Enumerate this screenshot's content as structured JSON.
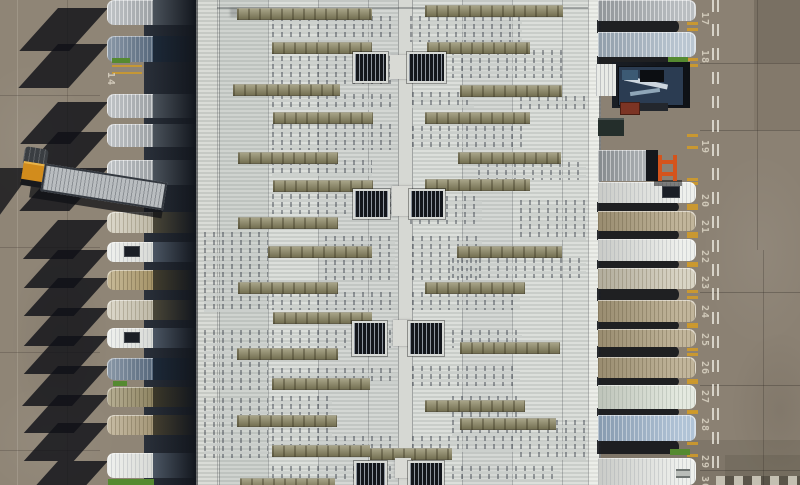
{
  "meta": {
    "title": "Aerial top-down view of a logistics warehouse: trailers docked at numbered loading bays on both sides of a corrugated roof with skylight strips and louvered vents",
    "width": 800,
    "height": 485
  },
  "palette": {
    "pavement_left": "#8f8576",
    "pavement_right": "#8b8173",
    "roof_light": "#dcdfdb",
    "roof_dark": "#c9cdc9",
    "fascia": "#d0d3ce",
    "ridge": "#d6d8d3",
    "skylight": "#8e8965",
    "vent_dark": "#13161b",
    "shadow": "#15161c",
    "dock_dark": "#12161d",
    "yellow_mark": "#cf9a2a",
    "grass_green": "#558a30",
    "tractor_orange": "#d28c1c",
    "forklift_orange": "#d4541c",
    "crate_red": "#7c3424",
    "flatbed_navy": "#2b3c52",
    "paint_white": "#ddd6c6",
    "trailer_types": {
      "silver": {
        "nose": "#a9aeb2",
        "mid": "#4e565f",
        "ribs": "rgba(255,255,255,0.5)"
      },
      "white": {
        "nose": "#eaece8",
        "mid": "#4f5a68",
        "ribs": "rgba(160,165,170,0.35)"
      },
      "navy": {
        "nose": "#5e7186",
        "mid": "#1d2a3a",
        "ribs": "rgba(255,255,255,0.25)"
      },
      "cream": {
        "nose": "#cfc9b6",
        "mid": "#4d4939",
        "ribs": "rgba(110,100,75,0.3)"
      },
      "gold": {
        "nose": "#b3a071",
        "mid": "#45402f",
        "ribs": "rgba(90,78,50,0.35)"
      },
      "olive": {
        "nose": "#9b906b",
        "mid": "#3e3a2a",
        "ribs": "rgba(80,72,48,0.35)"
      },
      "tan": {
        "nose": "#b2a382",
        "mid": "#474130",
        "ribs": "rgba(95,84,58,0.32)"
      },
      "mint": {
        "nose": "#dde4d8",
        "mid": "#4f5a50",
        "ribs": "rgba(150,160,150,0.35)"
      },
      "lightblue": {
        "nose": "#9db4cc",
        "mid": "#3c4a5c",
        "ribs": "rgba(255,255,255,0.4)"
      },
      "bluesilver": {
        "nose": "#a9b8c6",
        "mid": "#45505c",
        "ribs": "rgba(255,255,255,0.45)"
      },
      "grayshort": {
        "nose": "#9aa0a4",
        "mid": "#45494d",
        "ribs": "rgba(255,255,255,0.45)"
      }
    }
  },
  "left_yard": {
    "x": 0,
    "w": 196,
    "seams_v": [
      {
        "x": 17,
        "c": "rgba(232,227,216,0.18)"
      },
      {
        "x": 67,
        "c": "rgba(40,36,30,0.18)"
      }
    ],
    "seams_h": [
      95,
      247,
      352,
      450
    ],
    "yellow_dashes": [
      {
        "x": 112,
        "y": 65,
        "w": 30
      },
      {
        "x": 112,
        "y": 72,
        "w": 30
      }
    ],
    "bay_number": {
      "label": "14",
      "x": 103,
      "y": 72
    },
    "blotches": [
      {
        "x": -30,
        "y": 60,
        "w": 120,
        "h": 160,
        "c": "rgba(255,255,255,0.05)"
      },
      {
        "x": 10,
        "y": 250,
        "w": 100,
        "h": 180,
        "c": "rgba(40,35,28,0.08)"
      },
      {
        "x": -20,
        "y": 380,
        "w": 140,
        "h": 120,
        "c": "rgba(255,255,255,0.04)"
      }
    ],
    "green_slivers": [
      {
        "x": 112,
        "y": 58,
        "w": 18,
        "h": 5
      },
      {
        "x": 113,
        "y": 381,
        "w": 14,
        "h": 5
      },
      {
        "x": 108,
        "y": 479,
        "w": 46,
        "h": 6
      }
    ]
  },
  "right_yard": {
    "x": 598,
    "w": 202,
    "lane_lines_x": [
      712,
      717
    ],
    "seams_h": [
      63,
      130,
      292,
      385,
      470
    ],
    "seams_v": [
      {
        "x": 757,
        "y": 0,
        "h": 250
      },
      {
        "x": 763,
        "y": 250,
        "h": 235
      }
    ],
    "slabs": [
      {
        "x": 754,
        "y": 0,
        "w": 46,
        "h": 63,
        "c": "rgba(30,26,20,0.16)"
      },
      {
        "x": 754,
        "y": 63,
        "w": 46,
        "h": 67,
        "c": "rgba(30,26,20,0.07)"
      },
      {
        "x": 598,
        "y": 440,
        "w": 202,
        "h": 45,
        "c": "rgba(30,26,20,0.10)"
      },
      {
        "x": 725,
        "y": 455,
        "w": 75,
        "h": 30,
        "c": "rgba(30,26,20,0.10)"
      }
    ],
    "blotches": [
      {
        "x": 700,
        "y": 150,
        "w": 120,
        "h": 200,
        "c": "rgba(255,255,255,0.05)"
      },
      {
        "x": 730,
        "y": 330,
        "w": 100,
        "h": 160,
        "c": "rgba(35,30,22,0.09)"
      }
    ],
    "crosswalk": {
      "x": 716,
      "y": 476,
      "w": 84,
      "h": 9
    },
    "bay_numbers": [
      {
        "label": "17",
        "y": 12
      },
      {
        "label": "18",
        "y": 50
      },
      {
        "label": "19",
        "y": 140
      },
      {
        "label": "20",
        "y": 194
      },
      {
        "label": "21",
        "y": 220
      },
      {
        "label": "22",
        "y": 250
      },
      {
        "label": "23",
        "y": 276
      },
      {
        "label": "24",
        "y": 305
      },
      {
        "label": "25",
        "y": 333
      },
      {
        "label": "26",
        "y": 361
      },
      {
        "label": "27",
        "y": 390
      },
      {
        "label": "28",
        "y": 418
      },
      {
        "label": "29",
        "y": 455
      },
      {
        "label": "30",
        "y": 476
      }
    ],
    "numbers_x": 697,
    "extra_bay_marks_y": [
      64,
      134
    ],
    "green_slivers": [
      {
        "x": 668,
        "y": 57,
        "w": 20,
        "h": 5
      },
      {
        "x": 670,
        "y": 449,
        "w": 20,
        "h": 6
      }
    ]
  },
  "roof": {
    "x": 196,
    "w": 402,
    "fascia_left": {
      "x": 196,
      "w": 21
    },
    "fascia_right": {
      "x": 588,
      "w": 10
    },
    "ridge": {
      "x": 398,
      "w": 13
    },
    "seams_x": [
      217,
      268,
      318,
      368,
      462,
      512,
      562
    ],
    "top_edge_y": 7,
    "column_tints": [
      {
        "x": 217,
        "w": 51,
        "c": "rgba(100,105,112,0.10)"
      },
      {
        "x": 318,
        "w": 82,
        "c": "rgba(90,95,100,0.06)"
      },
      {
        "x": 462,
        "w": 50,
        "c": "rgba(95,100,108,0.05)"
      }
    ],
    "skylights": [
      [
        237,
        8,
        135
      ],
      [
        425,
        5,
        138
      ],
      [
        272,
        42,
        100
      ],
      [
        427,
        42,
        103
      ],
      [
        233,
        84,
        107
      ],
      [
        460,
        85,
        102
      ],
      [
        273,
        112,
        100
      ],
      [
        425,
        112,
        105
      ],
      [
        238,
        152,
        100
      ],
      [
        458,
        152,
        103
      ],
      [
        273,
        180,
        100
      ],
      [
        425,
        179,
        105
      ],
      [
        238,
        217,
        100
      ],
      [
        268,
        246,
        104
      ],
      [
        457,
        246,
        105
      ],
      [
        238,
        282,
        100
      ],
      [
        425,
        282,
        100
      ],
      [
        273,
        312,
        99
      ],
      [
        237,
        348,
        101
      ],
      [
        460,
        342,
        100
      ],
      [
        272,
        378,
        98
      ],
      [
        425,
        400,
        100
      ],
      [
        237,
        415,
        100
      ],
      [
        460,
        418,
        96
      ],
      [
        272,
        445,
        98
      ],
      [
        370,
        448,
        82
      ],
      [
        240,
        478,
        95
      ]
    ],
    "vents": [
      [
        353,
        52,
        31,
        27
      ],
      [
        407,
        52,
        35,
        27
      ],
      [
        353,
        189,
        33,
        26
      ],
      [
        409,
        189,
        32,
        26
      ],
      [
        352,
        321,
        31,
        31
      ],
      [
        408,
        321,
        32,
        31
      ],
      [
        354,
        461,
        29,
        24
      ],
      [
        408,
        461,
        32,
        24
      ]
    ],
    "ridge_patches": [
      [
        390,
        55,
        22,
        24
      ],
      [
        392,
        186,
        20,
        30
      ],
      [
        393,
        320,
        18,
        26
      ],
      [
        395,
        458,
        16,
        20
      ]
    ],
    "dot_blocks": [
      [
        272,
        16,
        126,
        24
      ],
      [
        410,
        16,
        112,
        26
      ],
      [
        272,
        56,
        126,
        28
      ],
      [
        452,
        50,
        110,
        28
      ],
      [
        272,
        94,
        126,
        16
      ],
      [
        412,
        92,
        62,
        16
      ],
      [
        520,
        96,
        66,
        14
      ],
      [
        272,
        124,
        126,
        26
      ],
      [
        412,
        126,
        110,
        22
      ],
      [
        272,
        160,
        100,
        16
      ],
      [
        478,
        162,
        108,
        18
      ],
      [
        272,
        194,
        126,
        20
      ],
      [
        410,
        196,
        72,
        28
      ],
      [
        204,
        232,
        64,
        80
      ],
      [
        325,
        236,
        70,
        44
      ],
      [
        412,
        236,
        70,
        44
      ],
      [
        452,
        258,
        134,
        20
      ],
      [
        520,
        200,
        66,
        40
      ],
      [
        272,
        292,
        126,
        18
      ],
      [
        412,
        292,
        108,
        18
      ],
      [
        204,
        330,
        64,
        60
      ],
      [
        272,
        330,
        126,
        18
      ],
      [
        452,
        330,
        70,
        18
      ],
      [
        272,
        368,
        126,
        16
      ],
      [
        412,
        366,
        108,
        20
      ],
      [
        272,
        396,
        60,
        40
      ],
      [
        452,
        396,
        70,
        40
      ],
      [
        204,
        398,
        64,
        60
      ],
      [
        520,
        420,
        66,
        40
      ],
      [
        272,
        436,
        126,
        16
      ],
      [
        412,
        436,
        108,
        16
      ],
      [
        272,
        466,
        126,
        14
      ],
      [
        452,
        466,
        108,
        14
      ]
    ]
  },
  "left_dock": {
    "strip_x": 144,
    "strip_w": 52,
    "nose_x": 107,
    "nose_w": 46,
    "body_x": 150,
    "body_w": 46
  },
  "left_trailers": [
    {
      "y": 0,
      "h": 25,
      "type": "silver"
    },
    {
      "y": 36,
      "h": 26,
      "type": "navy"
    },
    {
      "y": 94,
      "h": 24,
      "type": "silver"
    },
    {
      "y": 124,
      "h": 23,
      "type": "silver"
    },
    {
      "y": 160,
      "h": 25,
      "type": "silver"
    },
    {
      "y": 212,
      "h": 21,
      "type": "cream"
    },
    {
      "y": 242,
      "h": 20,
      "type": "white",
      "hatch": true
    },
    {
      "y": 270,
      "h": 20,
      "type": "gold"
    },
    {
      "y": 300,
      "h": 20,
      "type": "cream"
    },
    {
      "y": 328,
      "h": 20,
      "type": "white",
      "hatch": true
    },
    {
      "y": 358,
      "h": 22,
      "type": "navy"
    },
    {
      "y": 387,
      "h": 20,
      "type": "olive"
    },
    {
      "y": 415,
      "h": 20,
      "type": "tan"
    },
    {
      "y": 453,
      "h": 25,
      "type": "white"
    }
  ],
  "right_trailers": [
    {
      "y": 0,
      "h": 21,
      "type": "silver"
    },
    {
      "y": 32,
      "h": 25,
      "type": "bluesilver"
    },
    {
      "y": 150,
      "h": 31,
      "type": "grayshort",
      "len": 58,
      "darkend": true
    },
    {
      "y": 182,
      "h": 21,
      "type": "white",
      "hatch": true
    },
    {
      "y": 211,
      "h": 20,
      "type": "tan"
    },
    {
      "y": 239,
      "h": 22,
      "type": "white"
    },
    {
      "y": 268,
      "h": 21,
      "type": "cream"
    },
    {
      "y": 300,
      "h": 22,
      "type": "tan"
    },
    {
      "y": 329,
      "h": 18,
      "type": "tan"
    },
    {
      "y": 357,
      "h": 21,
      "type": "tan"
    },
    {
      "y": 385,
      "h": 24,
      "type": "mint"
    },
    {
      "y": 415,
      "h": 26,
      "type": "lightblue"
    },
    {
      "y": 458,
      "h": 27,
      "type": "white",
      "label": true
    }
  ],
  "vehicles": {
    "yard_tractor": {
      "x": 22,
      "y": 148,
      "angle_deg": 9,
      "cab_w": 26,
      "cab_h": 40,
      "trailer_w": 120,
      "trailer_h": 24
    },
    "flatbed_bay": {
      "cavity": [
        612,
        62,
        78,
        46
      ],
      "stub": [
        596,
        64,
        20,
        32
      ],
      "bed": [
        618,
        66,
        64,
        38
      ],
      "crate": [
        620,
        102,
        18,
        11
      ],
      "bar": [
        640,
        103,
        28,
        8
      ],
      "dumpster": [
        598,
        118,
        26,
        18
      ]
    },
    "forklift": {
      "x": 656,
      "y": 155,
      "w": 24,
      "h": 28
    }
  }
}
